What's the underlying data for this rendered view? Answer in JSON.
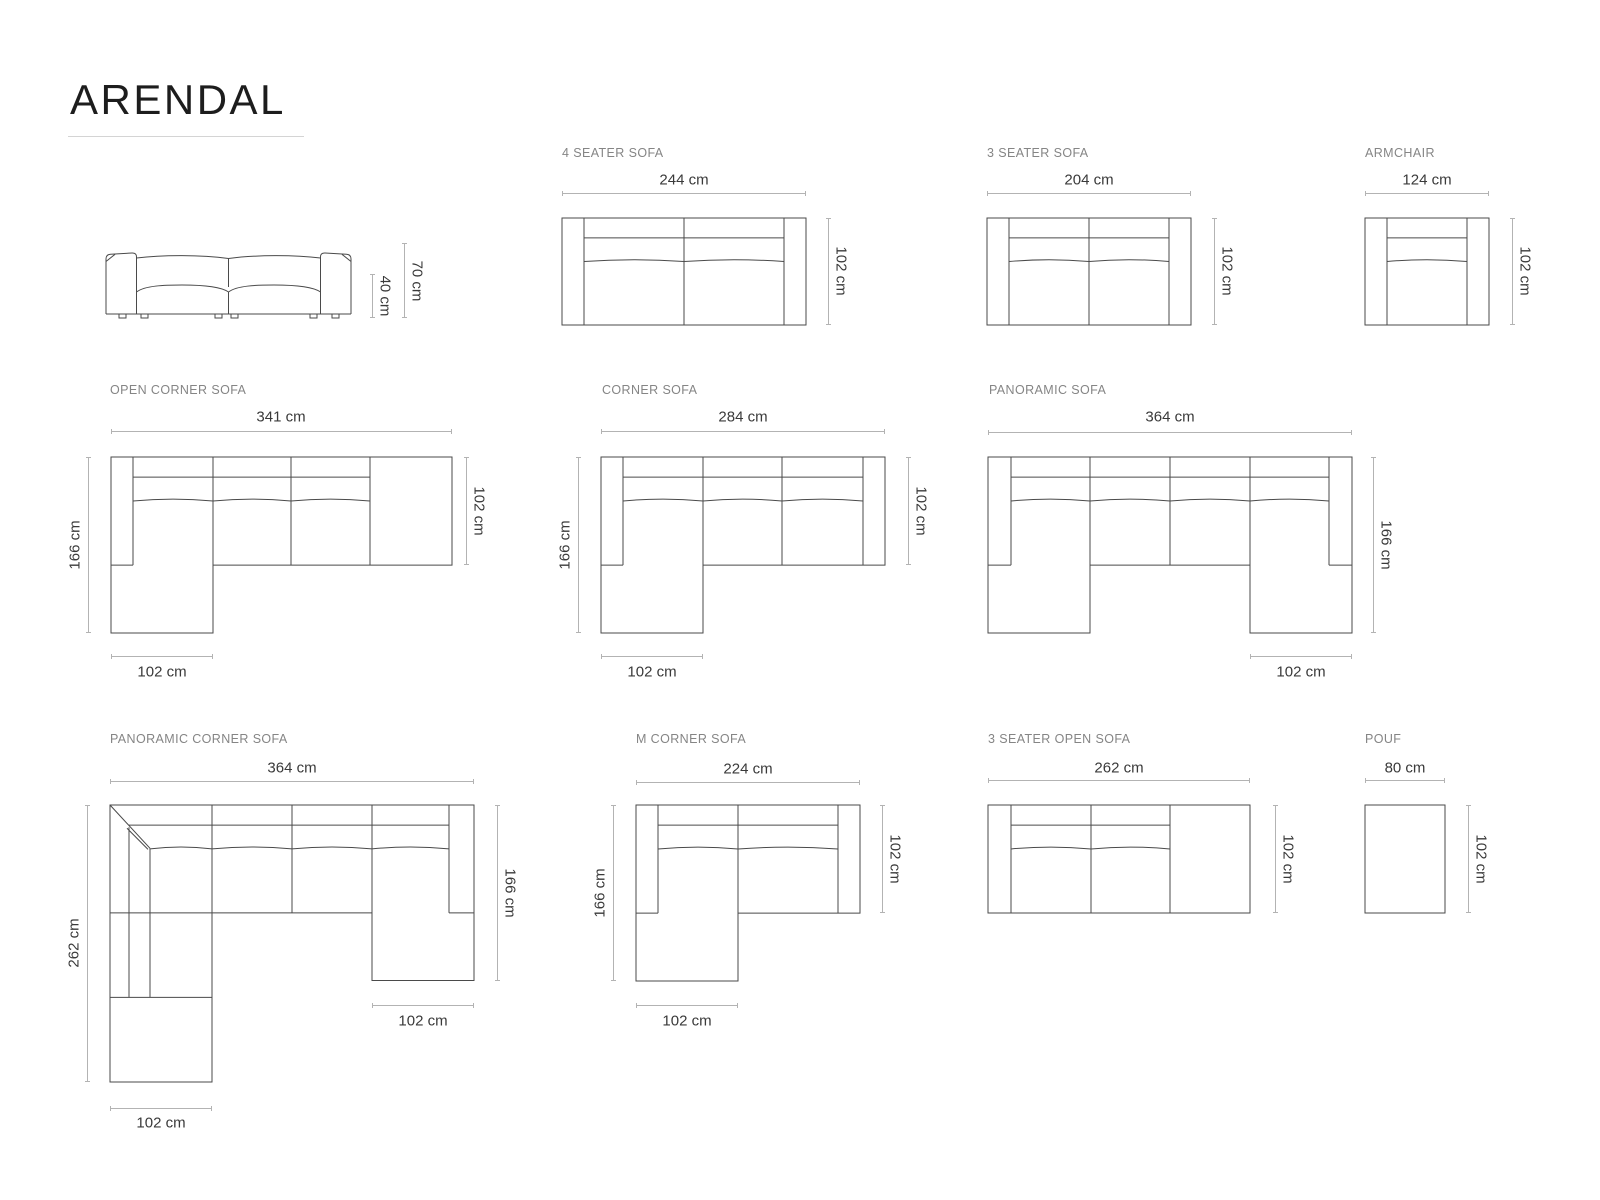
{
  "page": {
    "title": "ARENDAL"
  },
  "colors": {
    "drawing_line": "#4a4a4a",
    "dimension_line": "#b3b3b3",
    "label_text": "#858585",
    "dimension_text": "#3a3a3a",
    "title_text": "#1d1d1d"
  },
  "figures": {
    "front_view": {
      "dim_back_height": "70 cm",
      "dim_seat_height": "40 cm"
    },
    "four_seater_sofa": {
      "label": "4 SEATER SOFA",
      "dim_width": "244 cm",
      "dim_depth": "102 cm"
    },
    "three_seater_sofa": {
      "label": "3 SEATER SOFA",
      "dim_width": "204 cm",
      "dim_depth": "102 cm"
    },
    "armchair": {
      "label": "ARMCHAIR",
      "dim_width": "124 cm",
      "dim_depth": "102 cm"
    },
    "open_corner_sofa": {
      "label": "OPEN CORNER SOFA",
      "dim_width": "341 cm",
      "dim_total_depth": "166 cm",
      "dim_depth": "102 cm",
      "dim_chaise_width": "102 cm"
    },
    "corner_sofa": {
      "label": "CORNER SOFA",
      "dim_width": "284 cm",
      "dim_total_depth": "166 cm",
      "dim_depth": "102 cm",
      "dim_chaise_width": "102 cm"
    },
    "panoramic_sofa": {
      "label": "PANORAMIC SOFA",
      "dim_width": "364 cm",
      "dim_total_depth": "166 cm",
      "dim_chaise_width": "102 cm"
    },
    "panoramic_corner_sofa": {
      "label": "PANORAMIC CORNER SOFA",
      "dim_width": "364 cm",
      "dim_left_depth": "262 cm",
      "dim_right_depth": "166 cm",
      "dim_chaise_left_width": "102 cm",
      "dim_chaise_right_width": "102 cm"
    },
    "m_corner_sofa": {
      "label": "M CORNER SOFA",
      "dim_width": "224 cm",
      "dim_total_depth": "166 cm",
      "dim_depth": "102 cm",
      "dim_chaise_width": "102 cm"
    },
    "three_seater_open_sofa": {
      "label": "3 SEATER OPEN SOFA",
      "dim_width": "262 cm",
      "dim_depth": "102 cm"
    },
    "pouf": {
      "label": "POUF",
      "dim_width": "80 cm",
      "dim_depth": "102 cm"
    }
  }
}
